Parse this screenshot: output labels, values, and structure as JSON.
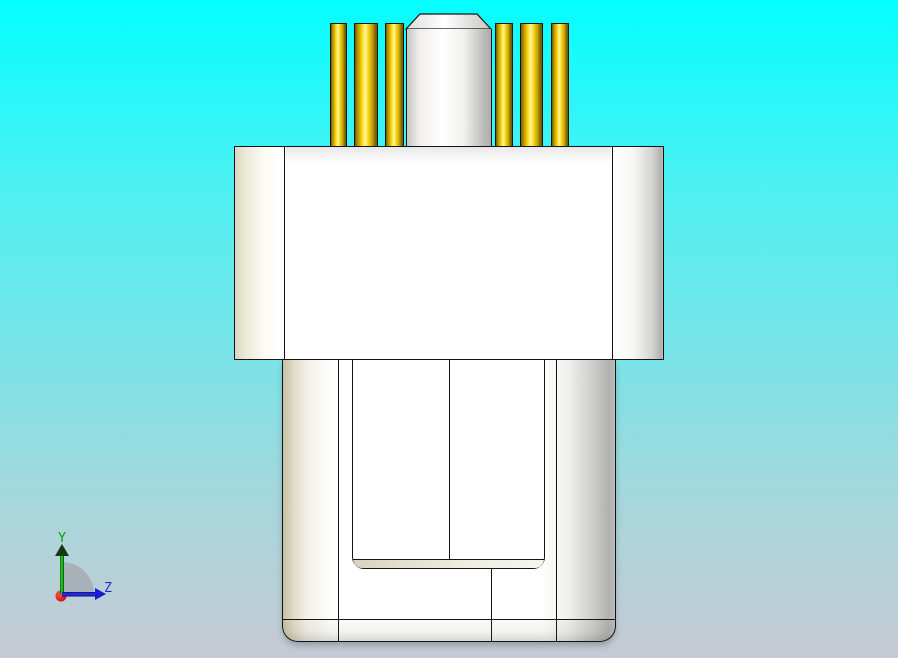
{
  "viewport": {
    "kind": "3d-cad-view"
  },
  "axis_triad": {
    "y_label": "Y",
    "z_label": "Z"
  },
  "colors": {
    "bg-top": "#04feff",
    "bg-mid": "#7ce3e7",
    "bg-bottom": "#c6cad4",
    "outline": "#141414",
    "body": "#ffffff",
    "shade-beige": "#d9d6c0",
    "shade-gray": "#b2b2b0",
    "pin-dark": "#6e5a04",
    "pin-gold": "#d2ab0a",
    "pin-bright": "#ffdf12",
    "pin-highlight": "#fdf4a8",
    "axis-y-label": "#00a300",
    "axis-z-label": "#2828cf",
    "axis-origin-dot": "#d51414",
    "axis-arc": "#a8aeb6"
  },
  "model": {
    "name": "connector-front-view",
    "pin_top": 23,
    "pin_height": 124,
    "pins": [
      {
        "x": 330,
        "w": 17
      },
      {
        "x": 354,
        "w": 24
      },
      {
        "x": 385,
        "w": 19
      },
      {
        "x": 495,
        "w": 18
      },
      {
        "x": 520,
        "w": 23
      },
      {
        "x": 551,
        "w": 18
      }
    ]
  }
}
